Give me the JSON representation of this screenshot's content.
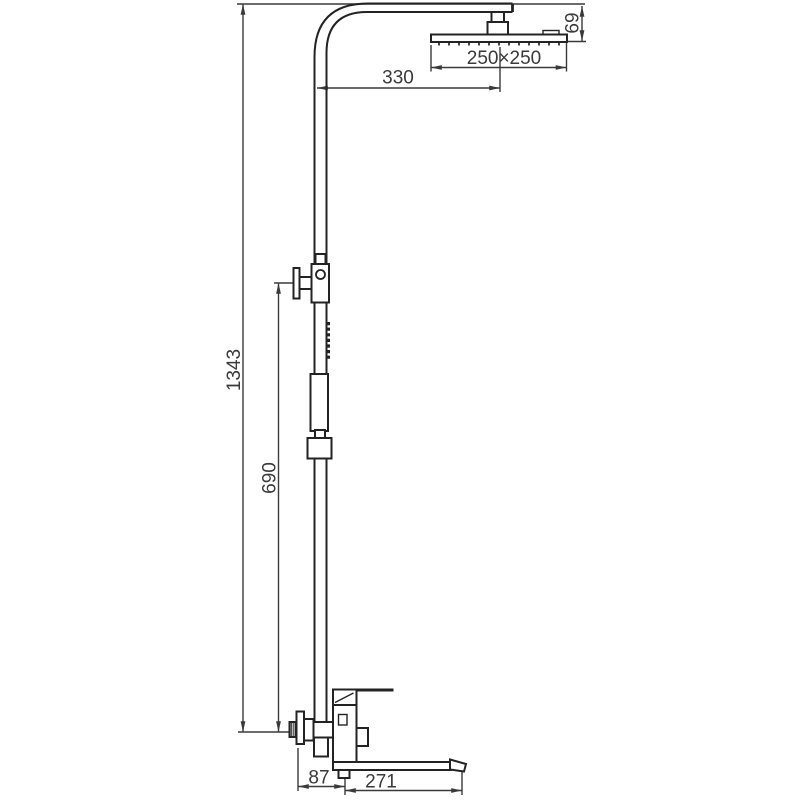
{
  "meta": {
    "type": "technical dimension drawing",
    "subject": "shower column set: square rain shower head, sliding hand-shower bracket, wall-mounted tub mixer with spout",
    "units": "mm"
  },
  "labels": {
    "total_height": "1343",
    "bracket_height": "690",
    "arm_reach": "330",
    "head_size": "250×250",
    "head_drop": "69",
    "spout_offset": "87",
    "spout_length": "271"
  },
  "colors": {
    "background": "#ffffff",
    "outline": "#232323",
    "dimension": "#3a3a3a"
  }
}
